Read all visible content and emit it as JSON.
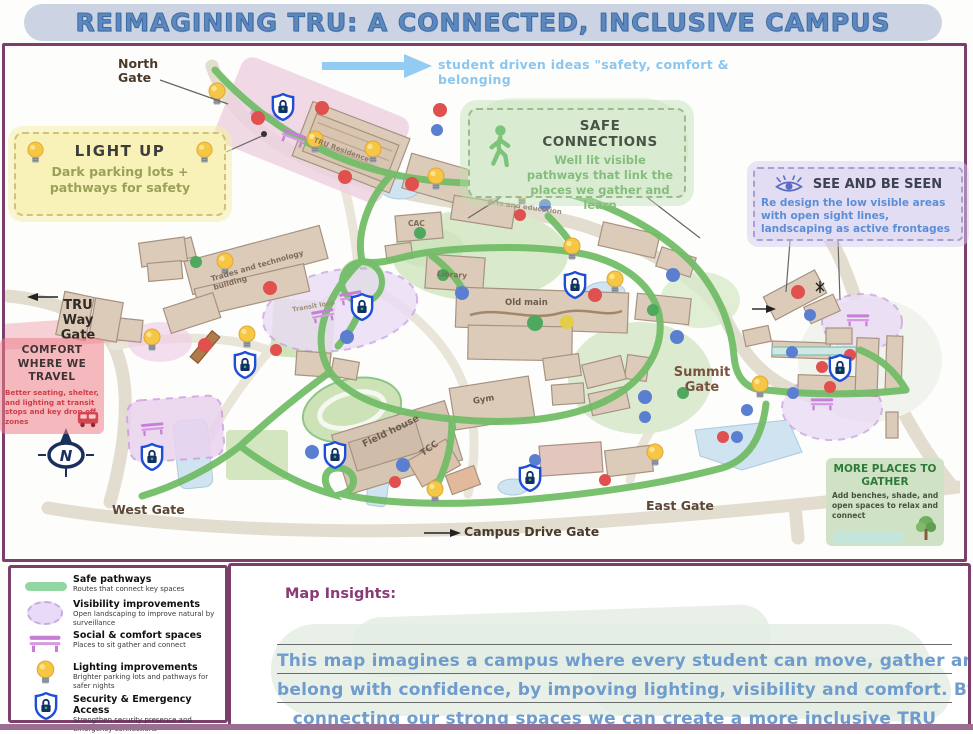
{
  "poster": {
    "title": "REIMAGINING TRU: A CONNECTED, INCLUSIVE CAMPUS",
    "arrow_note": "student driven ideas \"safety, comfort & belonging"
  },
  "map": {
    "gates": {
      "north": "North\nGate",
      "tru_way": "TRU\nWay\nGate",
      "west": "West Gate",
      "campus_drive": "Campus Drive Gate",
      "east": "East Gate",
      "summit": "Summit\nGate"
    },
    "buildings": {
      "trades": "Trades and technology building",
      "tru_residence": "TRU Residence",
      "cac": "CAC",
      "arts": "Arts and education",
      "library": "Library",
      "old_main": "Old main",
      "gym": "Gym",
      "field_house": "Field house",
      "tcc": "TCC",
      "transit_loop": "Transit loop"
    },
    "compass": "N"
  },
  "callouts": {
    "light_up": {
      "title": "LIGHT UP",
      "body": "Dark parking lots + pathways for safety"
    },
    "safe_connections": {
      "title": "SAFE CONNECTIONS",
      "body": "Well lit visible pathways that link the places we gather and learn"
    },
    "see_and_be_seen": {
      "title": "SEE AND BE SEEN",
      "body": "Re design the low visible areas with open sight lines, landscaping as active frontages"
    },
    "comfort_where_we_travel": {
      "title": "COMFORT WHERE WE TRAVEL",
      "body": "Better seating, shelter, and lighting at transit stops and key drop off zones"
    },
    "more_places_to_gather": {
      "title": "MORE PLACES TO GATHER",
      "body": "Add benches, shade, and open spaces to relax and connect"
    }
  },
  "legend": {
    "items": [
      {
        "icon": "safe-pathway-swatch",
        "title": "Safe pathways",
        "desc": "Routes that connect key spaces"
      },
      {
        "icon": "visibility-blob",
        "title": "Visibility improvements",
        "desc": "Open landscaping to improve natural by surveillance"
      },
      {
        "icon": "bench-icon",
        "title": "Social & comfort spaces",
        "desc": "Places to sit gather and connect"
      },
      {
        "icon": "lightbulb-icon",
        "title": "Lighting improvements",
        "desc": "Brighter parking lots and pathways for safer nights"
      },
      {
        "icon": "shield-lock-icon",
        "title": "Security & Emergency Access",
        "desc": "Strengthen security presence and emergency connections"
      }
    ]
  },
  "insights": {
    "heading": "Map Insights:",
    "lines": [
      "This map imagines a campus where every student can move, gather and",
      "belong with confidence, by impoving lighting, visibility and comfort. By",
      "connecting our strong spaces we can create a more inclusive TRU"
    ]
  },
  "colors": {
    "frame_purple": "#7c3e6b",
    "safe_path_green": "#72bd68",
    "note_blue": "#8cc6ef",
    "insight_blue": "#6f9ccd",
    "title_blue": "#5d87bd"
  }
}
